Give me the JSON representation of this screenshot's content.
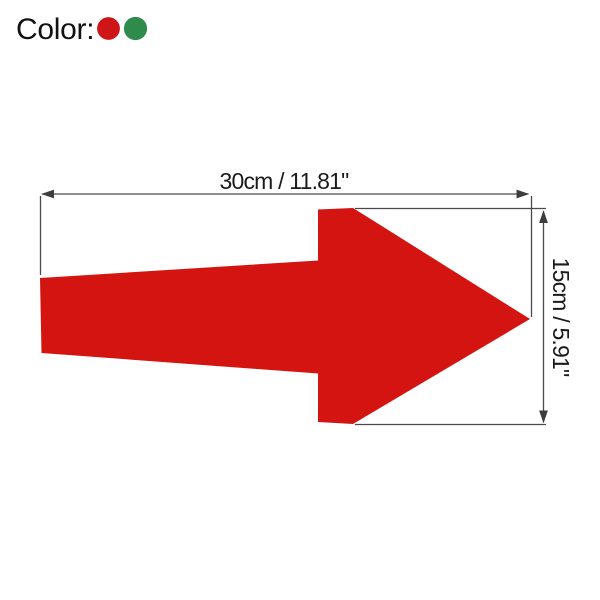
{
  "page": {
    "background": "#ffffff",
    "description_labels": {
      "legend_label": "Color:"
    }
  },
  "legend": {
    "label": "Color:",
    "label_color": "#111111",
    "options": [
      {
        "name": "red",
        "hex": "#ce1517"
      },
      {
        "name": "green",
        "hex": "#2e8b4c"
      }
    ]
  },
  "product": {
    "shape": "right-pointing-arrow-decal",
    "fill": "#d31411",
    "edge": "#b20e0c"
  },
  "dimensions": {
    "width_label": "30cm / 11.81\"",
    "height_label": "15cm / 5.91\"",
    "line_color": "#4a4a4a",
    "arrowhead_color": "#3d3d3d",
    "text_color": "#1a1a1a"
  }
}
